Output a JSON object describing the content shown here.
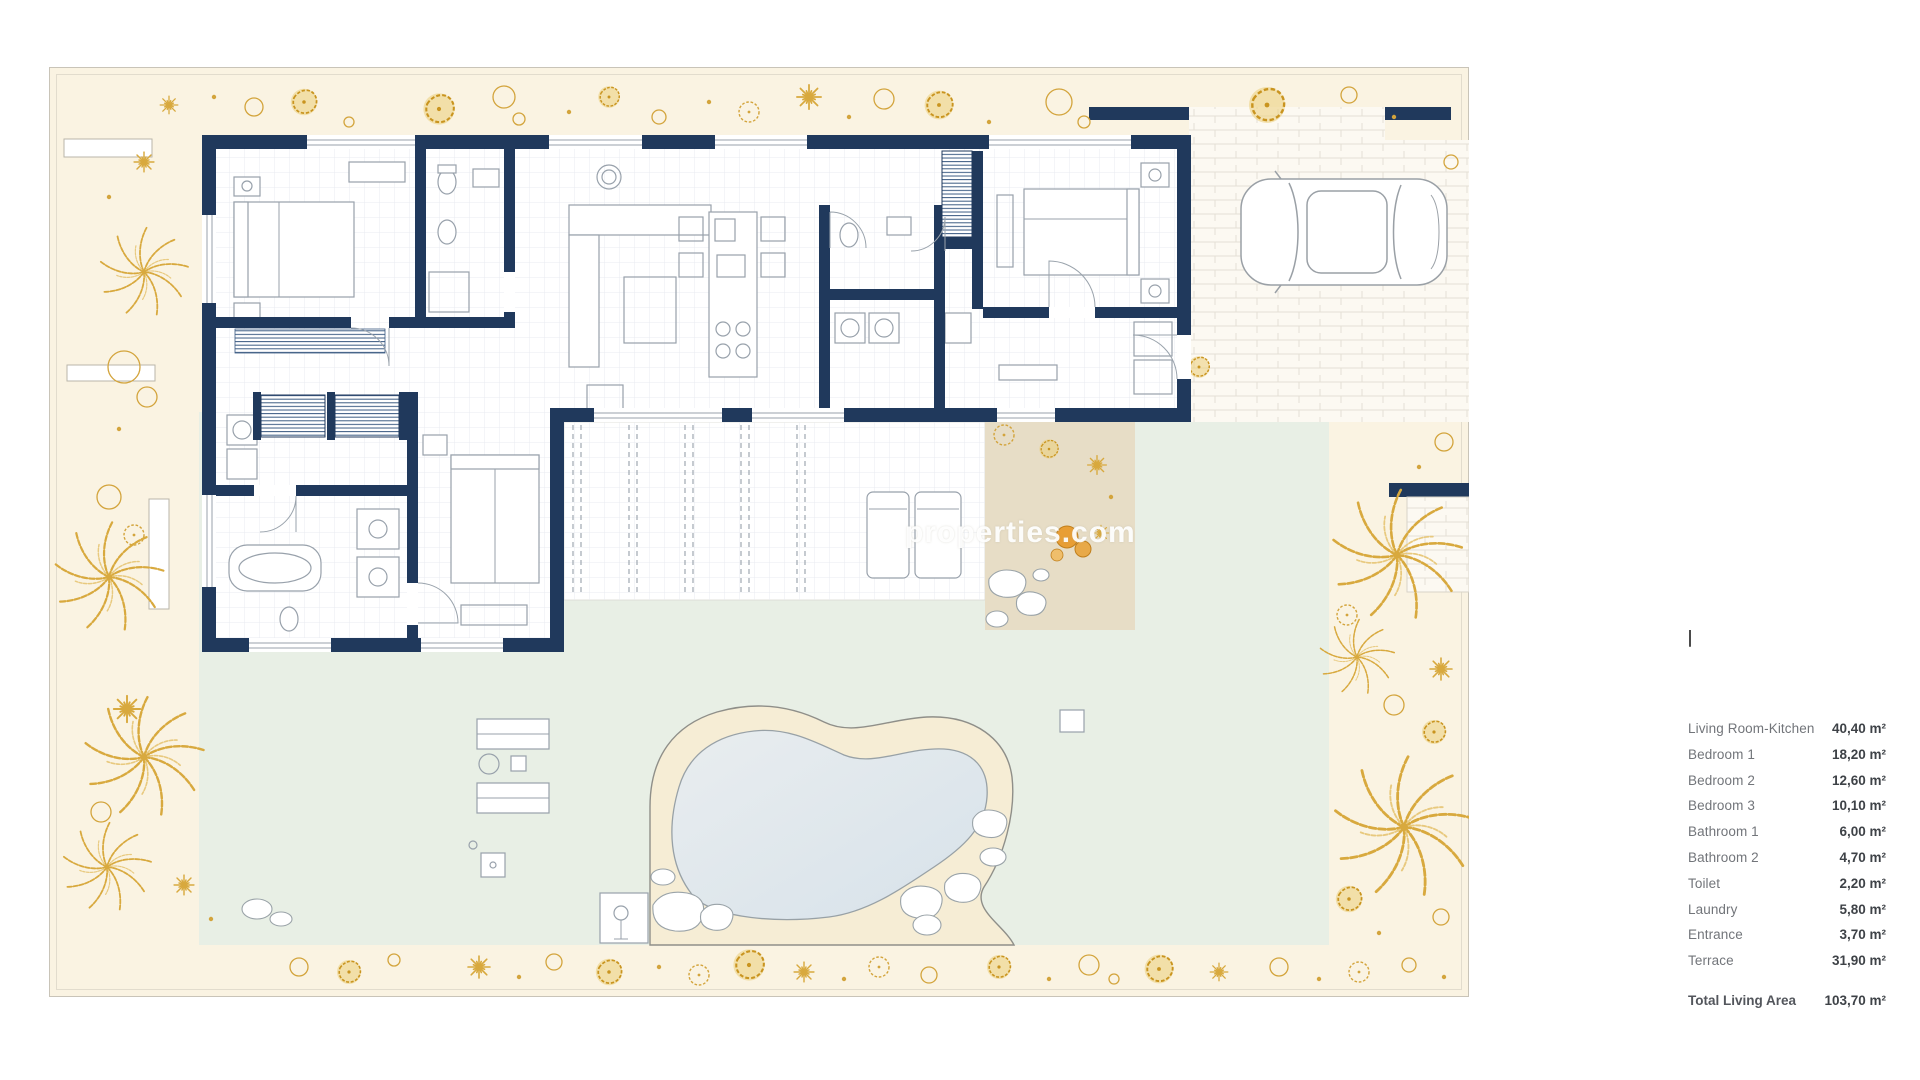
{
  "legend": {
    "items": [
      {
        "label": "Living Room-Kitchen",
        "value": "40,40 m²"
      },
      {
        "label": "Bedroom 1",
        "value": "18,20 m²"
      },
      {
        "label": "Bedroom 2",
        "value": "12,60 m²"
      },
      {
        "label": "Bedroom 3",
        "value": "10,10 m²"
      },
      {
        "label": "Bathroom 1",
        "value": "6,00 m²"
      },
      {
        "label": "Bathroom 2",
        "value": "4,70 m²"
      },
      {
        "label": "Toilet",
        "value": "2,20 m²"
      },
      {
        "label": "Laundry",
        "value": "5,80 m²"
      },
      {
        "label": "Entrance",
        "value": "3,70 m²"
      },
      {
        "label": "Terrace",
        "value": "31,90 m²"
      }
    ],
    "total": {
      "label": "Total Living Area",
      "value": "103,70 m²"
    }
  },
  "watermark": {
    "text": "properties.com"
  },
  "colors": {
    "wall_navy": "#20395C",
    "garden_cream": "#FAF3E2",
    "plant_gold": "#D8A93E",
    "terrace_green": "#E8EFE5",
    "pool_water": "#DCE6EB",
    "pool_deck_sand": "#F6EDD5",
    "mat_tan": "#E7DDC6"
  }
}
